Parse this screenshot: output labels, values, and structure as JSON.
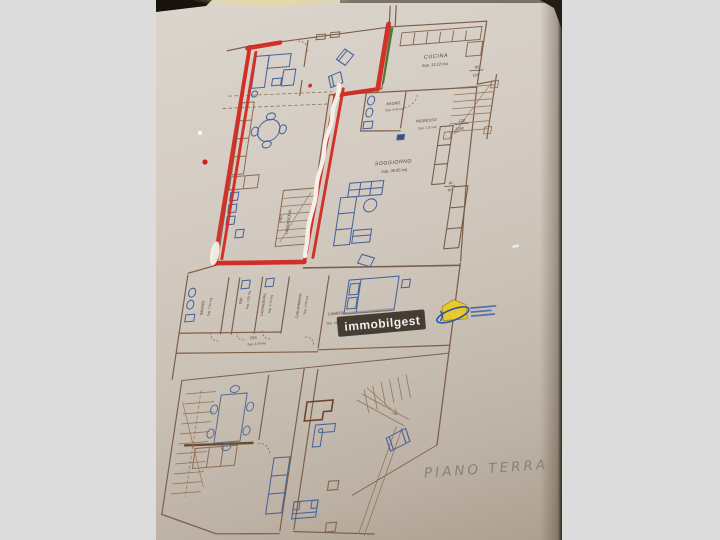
{
  "photo": {
    "background_color": "#dcdcdc",
    "marker_red": "#d22a21",
    "marker_green": "#4a7d2e",
    "whiteout": "#f4f0e7"
  },
  "plan": {
    "handwritten_title": "PIANO TERRA",
    "watermark": {
      "brand": "immobilgest"
    },
    "rooms": {
      "cucina": {
        "name": "CUCINA",
        "area": "Sup. 13.12 mq"
      },
      "bagno_small": {
        "name": "BAGNO",
        "area": "Sup. 4.45 mq"
      },
      "ingresso": {
        "name": "INGRESSO",
        "area": "Sup. 2.30 mq"
      },
      "soggiorno": {
        "name": "SOGGIORNO",
        "area": "Sup. 36.85 mq"
      },
      "rip_lavanderia": {
        "name": "RIP",
        "name2": "LAVANDERIA"
      },
      "bagno_large": {
        "name": "BAGNO",
        "area": "Sup. 7.50 mq"
      },
      "rip": {
        "name": "RIP",
        "area": "Sup. 3.92 mq"
      },
      "lavanderia": {
        "name": "LAVANDERIA",
        "area": "Sup. 4.74 mq"
      },
      "cab_armadio": {
        "name": "CAB ARMADIO",
        "area": "Sup. 6.50 mq"
      },
      "dis": {
        "name": "DIS",
        "area": "Sup. 3.34 mq"
      },
      "camera": {
        "name": "CAMERA",
        "area": "Sup. 24.03 mq"
      }
    },
    "dimensions": {
      "d1": {
        "top": "85",
        "bottom": "150"
      },
      "d2": {
        "top": "120",
        "bottom": "290"
      },
      "d3": {
        "top": "90",
        "bottom": "60"
      }
    }
  }
}
